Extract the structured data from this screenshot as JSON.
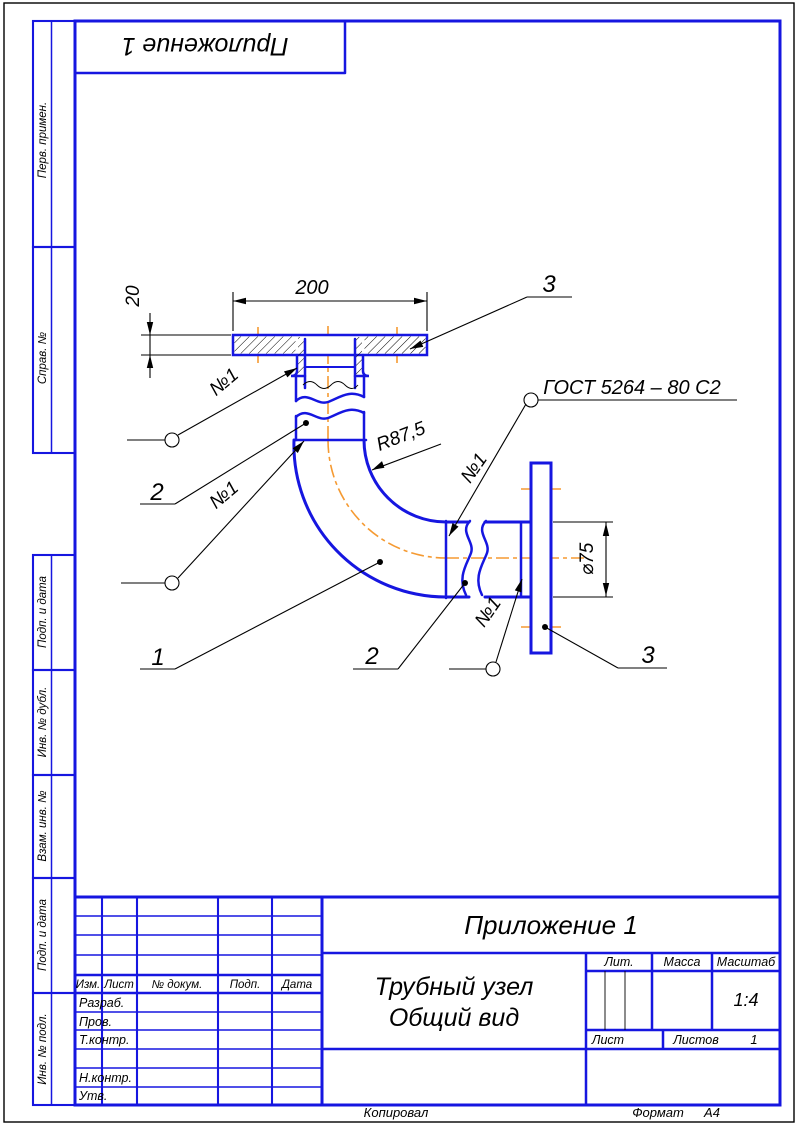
{
  "colors": {
    "blue": "#1616e0",
    "orange": "#f59a32",
    "ink": "#000000"
  },
  "top_label": {
    "text": "Приложение 1"
  },
  "side_strip": {
    "labels": [
      "Перв. примен.",
      "Справ. №",
      "Подп. и дата",
      "Инв. № дубл.",
      "Взам. инв. №",
      "Подп. и дата",
      "Инв. № подл."
    ]
  },
  "drawing": {
    "dim_width": "200",
    "dim_thickness": "20",
    "dim_radius": "R87,5",
    "dim_diameter": "⌀75",
    "weld_note": "ГОСТ 5264 – 80 С2",
    "weld_seam_labels": [
      "№1",
      "№1",
      "№1",
      "№1"
    ],
    "callouts": {
      "flange_top": "3",
      "pipe_upper": "2",
      "elbow": "1",
      "pipe_lower": "2",
      "flange_right": "3"
    }
  },
  "title_block": {
    "appendix": "Приложение 1",
    "name_line1": "Трубный узел",
    "name_line2": "Общий вид",
    "columns": [
      "Изм.",
      "Лист",
      "№ докум.",
      "Подп.",
      "Дата"
    ],
    "rows": [
      "Разраб.",
      "Пров.",
      "Т.контр.",
      "Н.контр.",
      "Утв."
    ],
    "lit": "Лит.",
    "mass": "Масса",
    "scale": "Масштаб",
    "scale_value": "1:4",
    "sheet": "Лист",
    "sheets": "Листов",
    "sheets_value": "1"
  },
  "footer": {
    "copied": "Копировал",
    "format": "Формат",
    "format_value": "А4"
  }
}
